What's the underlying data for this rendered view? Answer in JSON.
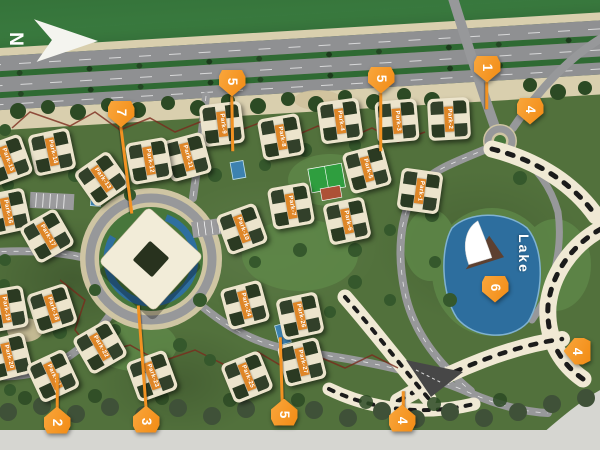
{
  "map": {
    "north_label": "N",
    "lake_label": "Lake",
    "colors": {
      "marker_orange": "#f7941f",
      "tag_orange": "#df8627",
      "residence_red": "#d5352b",
      "lake_blue": "#2d6e9e",
      "building_cream": "#ece4cc",
      "grass_green": "#3b7c40"
    },
    "markers": [
      {
        "number": "7",
        "x": 121,
        "y": 114,
        "dir": "down",
        "stem": {
          "x1": 121,
          "y1": 125,
          "x2": 132,
          "y2": 212
        }
      },
      {
        "number": "5",
        "x": 232,
        "y": 83,
        "dir": "down",
        "stem": {
          "x1": 232,
          "y1": 95,
          "x2": 233,
          "y2": 150
        }
      },
      {
        "number": "5",
        "x": 381,
        "y": 80,
        "dir": "down",
        "stem": {
          "x1": 381,
          "y1": 92,
          "x2": 381,
          "y2": 150
        }
      },
      {
        "number": "1",
        "x": 487,
        "y": 69,
        "dir": "down",
        "stem": {
          "x1": 487,
          "y1": 81,
          "x2": 487,
          "y2": 108
        }
      },
      {
        "number": "4",
        "x": 530,
        "y": 111,
        "dir": "down",
        "stem": null
      },
      {
        "number": "6",
        "x": 495,
        "y": 289,
        "dir": "down",
        "stem": null
      },
      {
        "number": "2",
        "x": 57,
        "y": 420,
        "dir": "up",
        "stem": {
          "x1": 57,
          "y1": 410,
          "x2": 57,
          "y2": 372
        }
      },
      {
        "number": "3",
        "x": 146,
        "y": 419,
        "dir": "up",
        "stem": {
          "x1": 146,
          "y1": 409,
          "x2": 138,
          "y2": 304
        }
      },
      {
        "number": "5",
        "x": 284,
        "y": 412,
        "dir": "up",
        "stem": {
          "x1": 282,
          "y1": 402,
          "x2": 280,
          "y2": 336
        }
      },
      {
        "number": "4",
        "x": 402,
        "y": 418,
        "dir": "up",
        "stem": {
          "x1": 403,
          "y1": 408,
          "x2": 403,
          "y2": 390
        }
      },
      {
        "number": "4",
        "x": 577,
        "y": 351,
        "dir": "left",
        "stem": null
      }
    ],
    "buildings": [
      {
        "name": "Park-1",
        "x": 420,
        "y": 191,
        "rot": 8
      },
      {
        "name": "Park-2",
        "x": 449,
        "y": 119,
        "rot": -3
      },
      {
        "name": "Park-3",
        "x": 397,
        "y": 121,
        "rot": -5
      },
      {
        "name": "Park-4",
        "x": 340,
        "y": 121,
        "rot": -8
      },
      {
        "name": "Park-5",
        "x": 367,
        "y": 169,
        "rot": -15
      },
      {
        "name": "Park-6",
        "x": 347,
        "y": 221,
        "rot": -12
      },
      {
        "name": "Park-7",
        "x": 291,
        "y": 206,
        "rot": -10
      },
      {
        "name": "Park-8",
        "x": 281,
        "y": 137,
        "rot": -10
      },
      {
        "name": "Park-9",
        "x": 222,
        "y": 124,
        "rot": -7
      },
      {
        "name": "Park-10",
        "x": 242,
        "y": 229,
        "rot": -20
      },
      {
        "name": "Park-11",
        "x": 187,
        "y": 157,
        "rot": -15
      },
      {
        "name": "Park-12",
        "x": 149,
        "y": 161,
        "rot": -10
      },
      {
        "name": "Park-13",
        "x": 102,
        "y": 179,
        "rot": -35
      },
      {
        "name": "Park-14",
        "x": 52,
        "y": 152,
        "rot": -12
      },
      {
        "name": "Park-15",
        "x": 7,
        "y": 160,
        "rot": -20
      },
      {
        "name": "Park-16",
        "x": 7,
        "y": 212,
        "rot": -12
      },
      {
        "name": "Park-17",
        "x": 47,
        "y": 236,
        "rot": -30
      },
      {
        "name": "Park-18",
        "x": 52,
        "y": 309,
        "rot": -18
      },
      {
        "name": "Park-19",
        "x": 5,
        "y": 309,
        "rot": -10
      },
      {
        "name": "Park-20",
        "x": 8,
        "y": 357,
        "rot": -14
      },
      {
        "name": "Park-21",
        "x": 53,
        "y": 376,
        "rot": -25
      },
      {
        "name": "Park-22",
        "x": 100,
        "y": 347,
        "rot": -30
      },
      {
        "name": "Park-23",
        "x": 152,
        "y": 376,
        "rot": -20
      },
      {
        "name": "Park-24",
        "x": 245,
        "y": 305,
        "rot": -15
      },
      {
        "name": "Park-25",
        "x": 247,
        "y": 377,
        "rot": -22
      },
      {
        "name": "Park-26",
        "x": 300,
        "y": 316,
        "rot": -12
      },
      {
        "name": "Park-27",
        "x": 302,
        "y": 362,
        "rot": -14
      }
    ],
    "residences": [
      {
        "name": "Residence 1",
        "x": 584,
        "y": 157,
        "rot": 90
      },
      {
        "name": "Residence 2",
        "x": 591,
        "y": 311,
        "rot": 90
      },
      {
        "name": "Residence 3",
        "x": 366,
        "y": 331,
        "rot": 52
      }
    ]
  }
}
